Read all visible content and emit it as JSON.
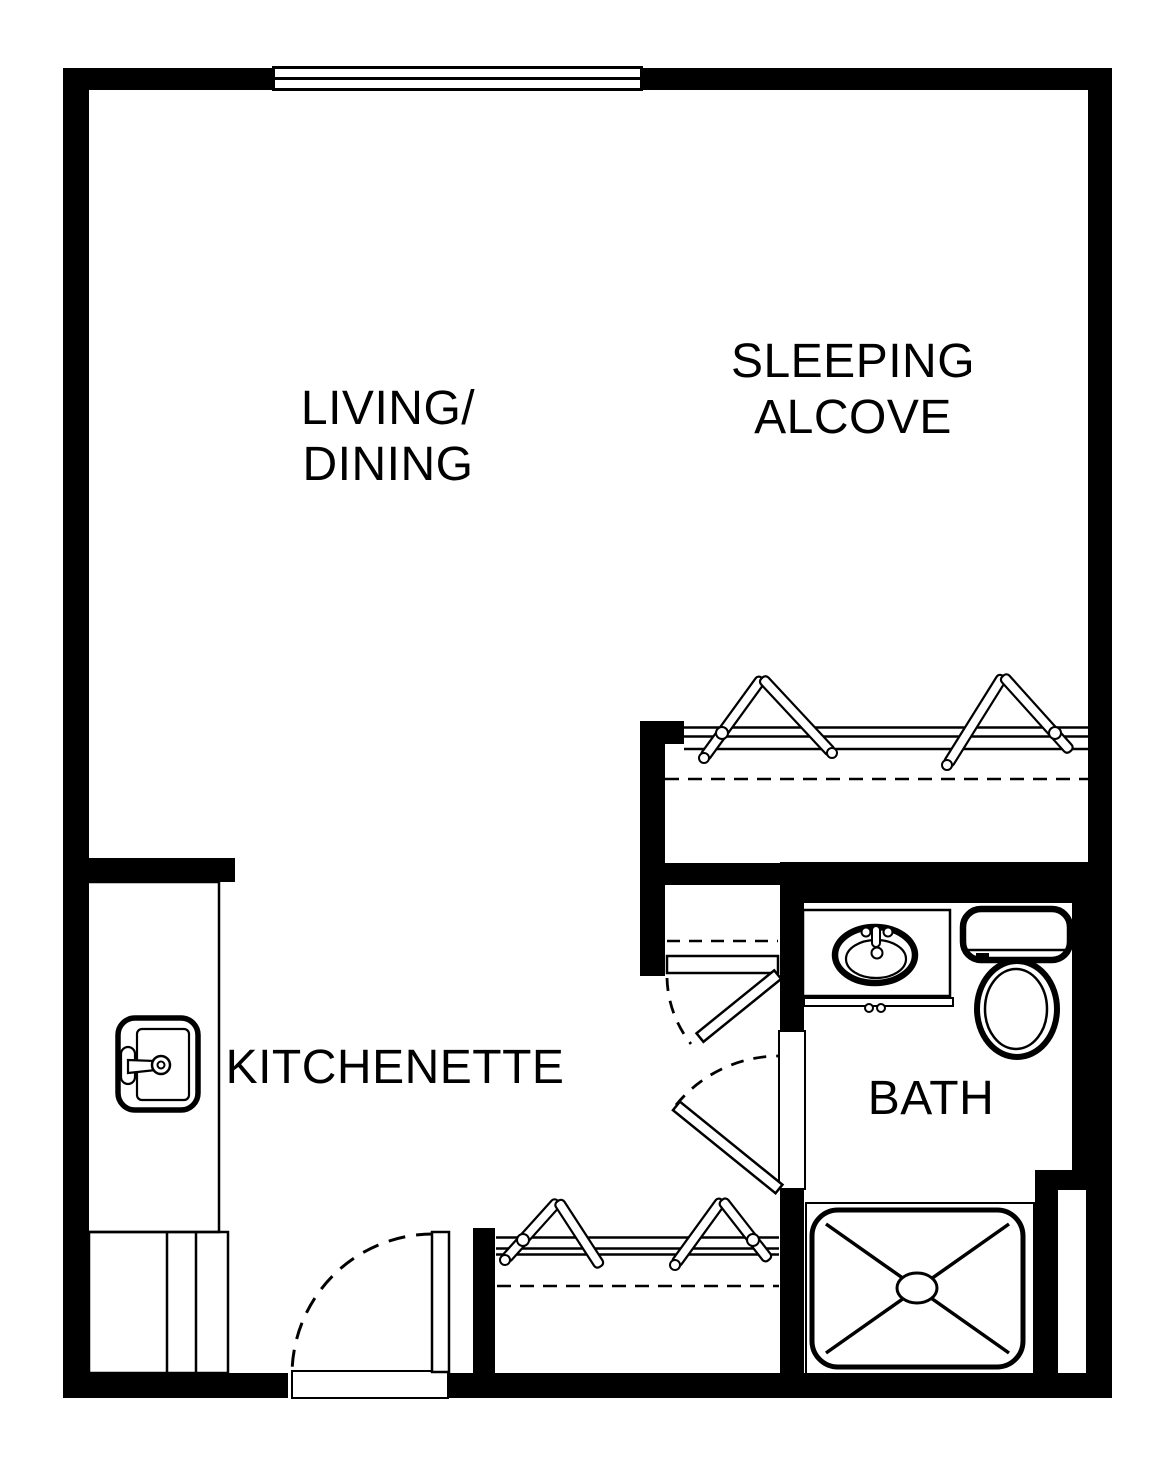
{
  "palette": {
    "line": "#000000",
    "background": "#ffffff"
  },
  "rooms": {
    "living_dining": {
      "line1": "LIVING/",
      "line2": "DINING"
    },
    "sleeping_alcove": {
      "line1": "SLEEPING",
      "line2": "ALCOVE"
    },
    "kitchenette": {
      "label": "KITCHENETTE"
    },
    "bath": {
      "label": "BATH"
    }
  },
  "fixtures": {
    "window": "window-icon",
    "kitchen_sink": "kitchen-sink-icon",
    "bathroom_sink": "bathroom-sink-icon",
    "toilet": "toilet-icon",
    "shower": "shower-icon",
    "entry_door": "entry-door-swing",
    "hall_door": "hall-door-swing",
    "bath_door": "bath-door-swing",
    "closet_hanger": "clothes-hanger-icon",
    "closet_rod": "closet-rod",
    "closet_shelf_dashed": "closet-shelf-outline"
  }
}
